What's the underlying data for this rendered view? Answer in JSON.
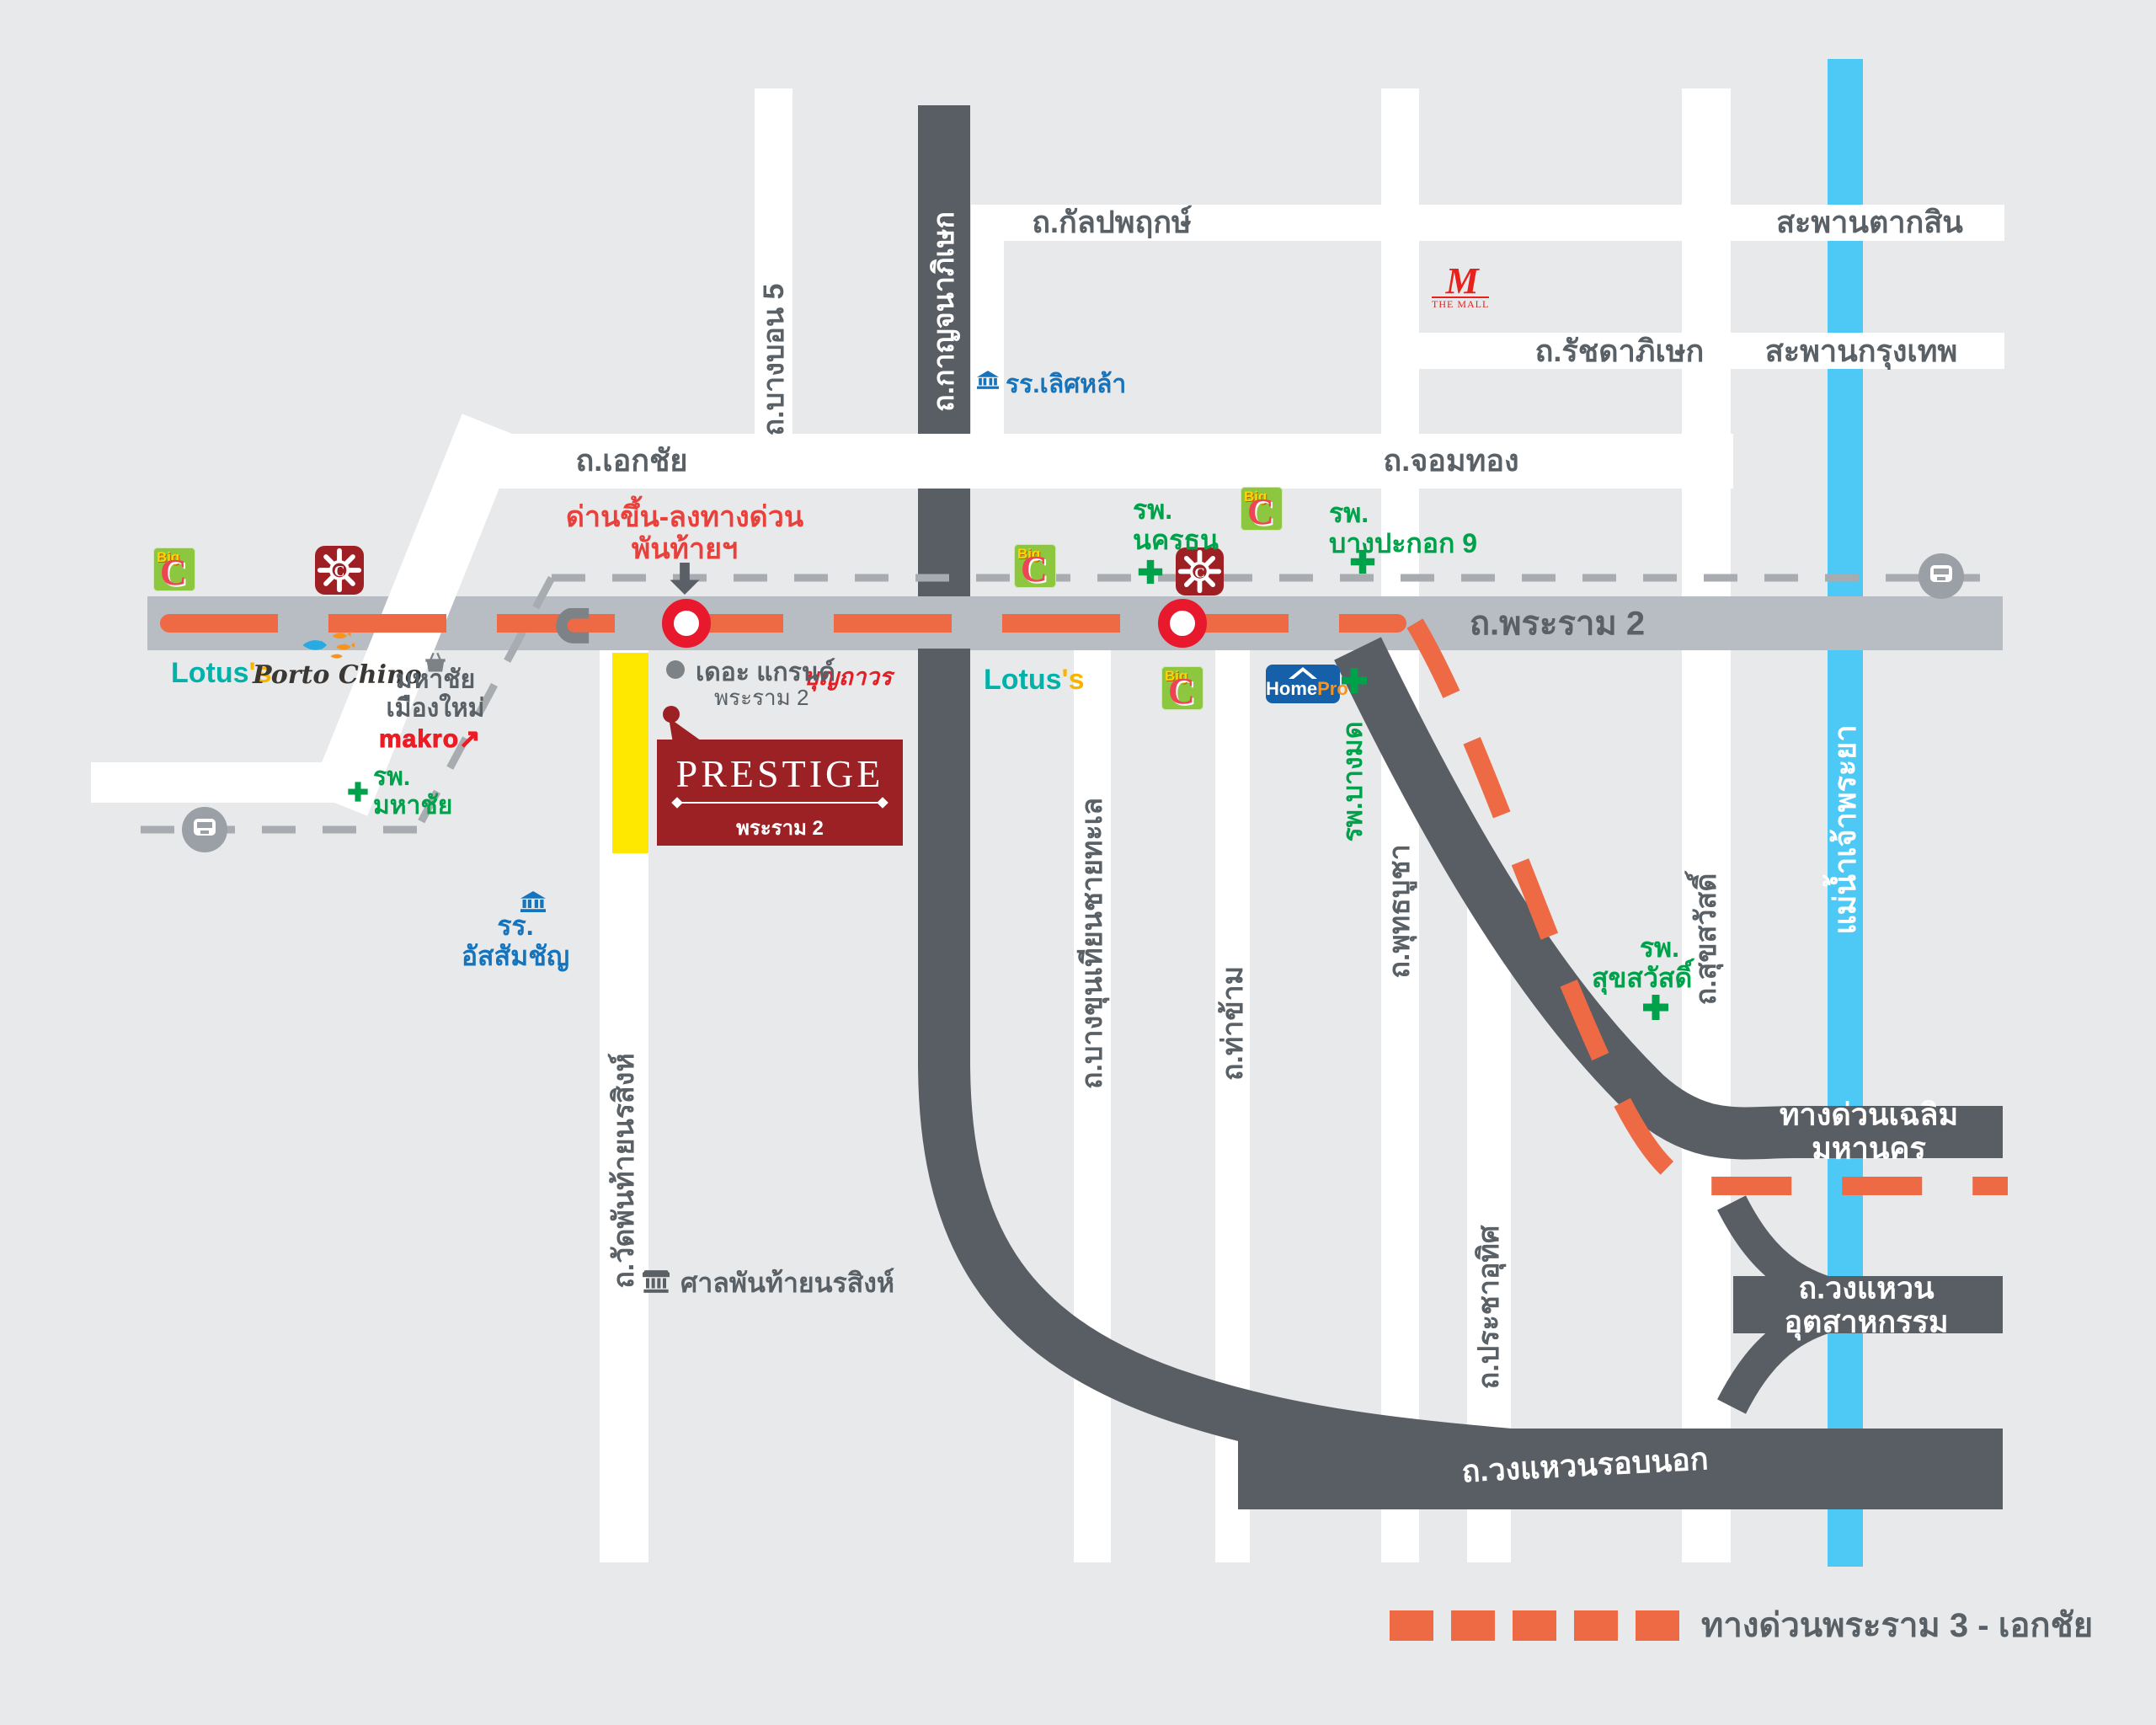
{
  "project": {
    "name": "PRESTIGE",
    "subtitle": "พระราม 2"
  },
  "roads": {
    "kalapapruek": "ถ.กัลปพฤกษ์",
    "chom_thong": "ถ.จอมทอง",
    "ekkachai": "ถ.เอกชัย",
    "bang_bon_5": "ถ.บางบอน 5",
    "kanchanaphisek": "ถ.กาญจนาภิเษก",
    "ratchadaphisek": "ถ.รัชดาภิเษก",
    "rama2": "ถ.พระราม 2",
    "wat_phanthai_norasing": "ถ.วัดพันท้ายนรสิงห์",
    "bang_khun_thian_chai_thale": "ถ.บางขุนเทียนชายทะเล",
    "tha_kham": "ถ.ท่าข้าม",
    "phuttha_bucha": "ถ.พุทธบูชา",
    "pracha_uthit": "ถ.ประชาอุทิศ",
    "suk_sawat": "ถ.สุขสวัสดิ์",
    "chalerm_mahanakhon_expressway": "ทางด่วนเฉลิมมหานคร",
    "industrial_ring": "ถ.วงแหวนอุตสาหกรรม",
    "outer_ring": "ถ.วงแหวนรอบนอก"
  },
  "bridges": {
    "taksin": "สะพานตากสิน",
    "krungthep": "สะพานกรุงเทพ"
  },
  "river": {
    "name": "แม่น้ำเจ้าพระยา"
  },
  "hospitals": {
    "mahachai": "รพ.\nมหาชัย",
    "nakhonthon": "รพ.\nนครธน",
    "bangpakok9": "รพ.\nบางปะกอก 9",
    "bangmod": "รพ.บางมด",
    "suksawat": "รพ.\nสุขสวัสดิ์"
  },
  "landmarks": {
    "toll_gate_note": "ด่านขึ้น-ลงทางด่วน\nพันท้ายฯ",
    "grand_rama2_line1": "เดอะ แกรนด์",
    "grand_rama2_line2": "พระราม 2",
    "boonthavorn": "บุญถาวร",
    "shrine": "ศาลพันท้ายนรสิงห์",
    "assumption_school": "รร.\nอัสสัมชัญ",
    "lertlah_school": "รร.เลิศหล้า",
    "mahachai_mueang_mai": "มหาชัย\nเมืองใหม่",
    "makro": "makro",
    "the_mall_mark": "M",
    "the_mall": "THE MALL",
    "lotus": "Lotus",
    "lotus_apostrophe": "'s",
    "porto_chino": "Porto Chino",
    "homepro_home": "Home",
    "homepro_pro": "Pro",
    "bigc_big": "Big",
    "bigc_c": "C"
  },
  "legend": {
    "rama3_ekkachai_expressway": "ทางด่วนพระราม 3 - เอกชัย"
  },
  "colors": {
    "background": "#e8e9ea",
    "road_white": "#ffffff",
    "rama2_gray": "#b8bdc4",
    "dark_road": "#595e64",
    "river_blue": "#4ec9f5",
    "expressway_red": "#ee6a45",
    "note_red": "#e8413c",
    "hospital_green": "#00a14b",
    "school_blue": "#1574bc",
    "prestige_maroon": "#9b2125"
  }
}
